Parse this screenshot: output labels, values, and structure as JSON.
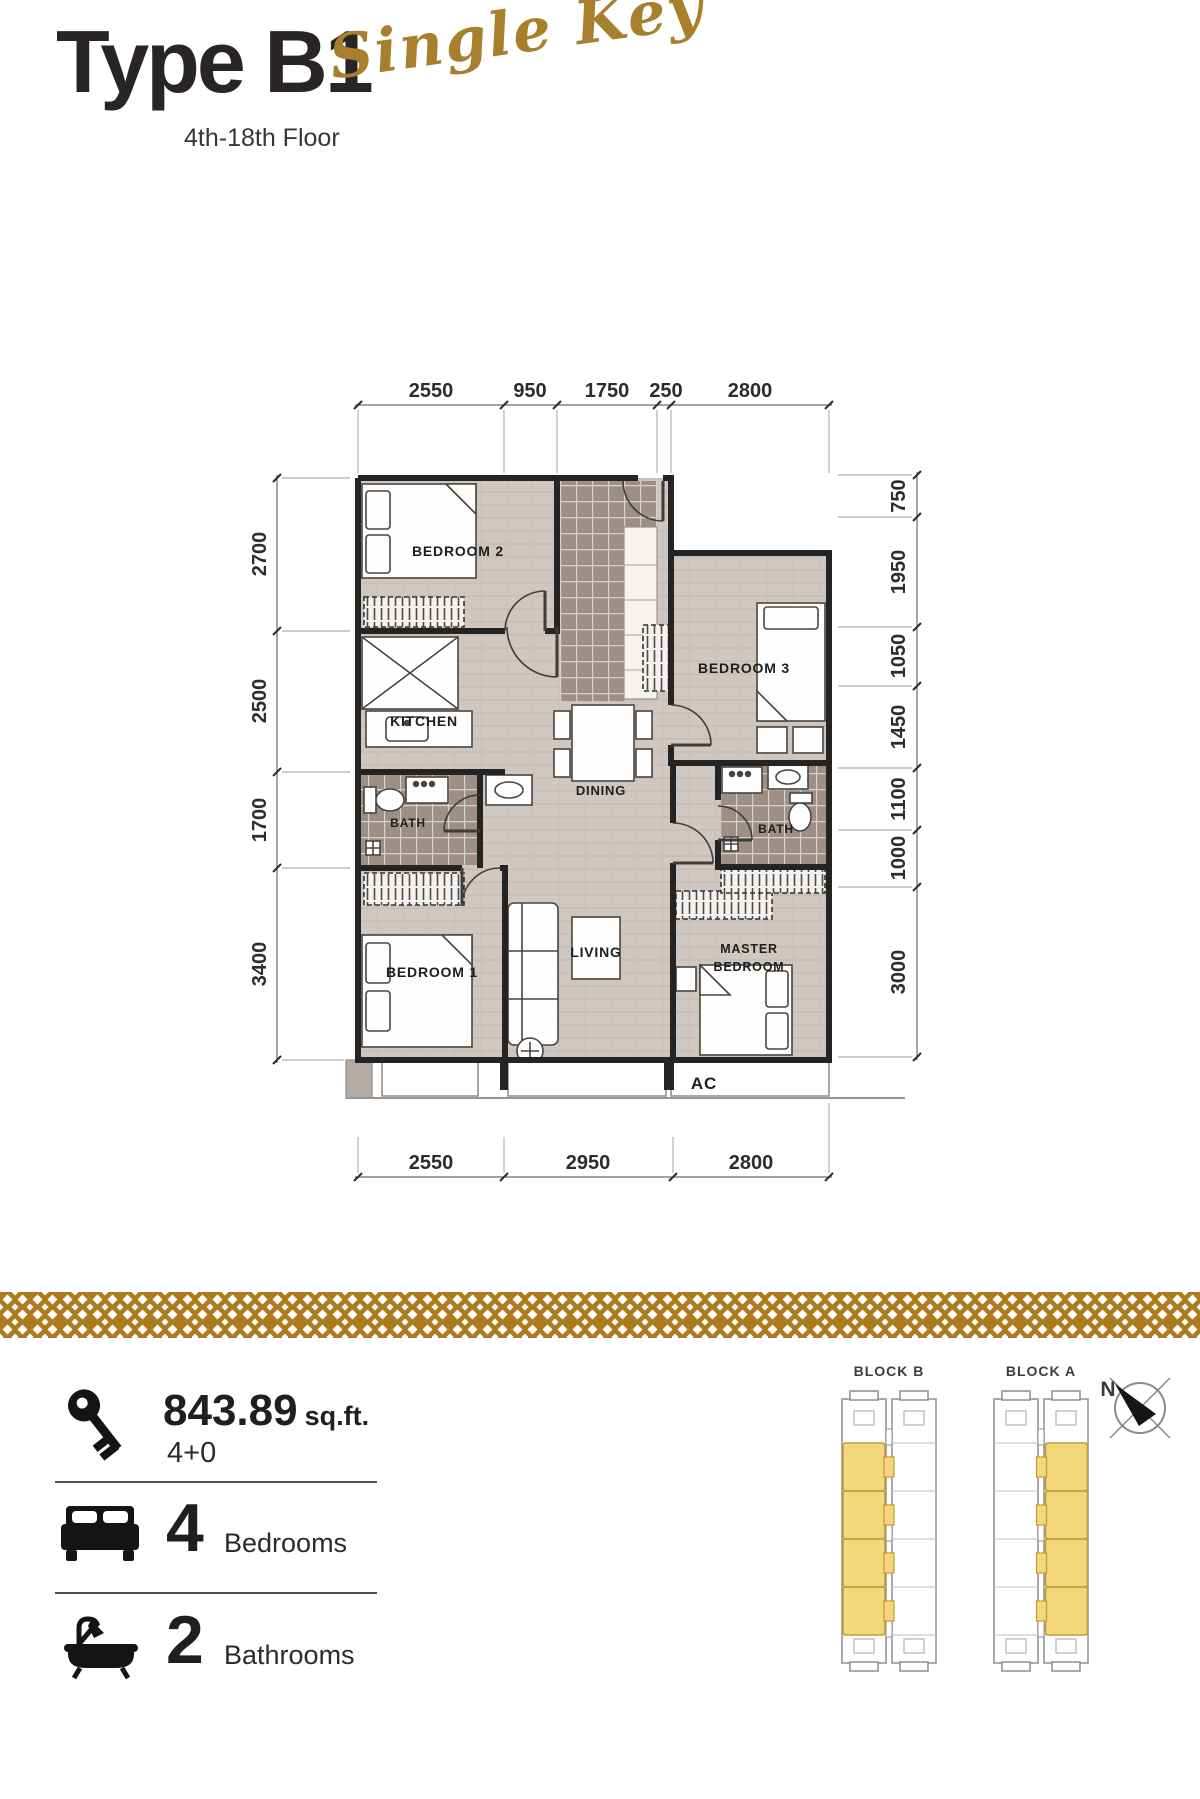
{
  "header": {
    "title": "Type B1",
    "floors": "4th-18th Floor",
    "script": "Single Key",
    "script_color": "#a8802d"
  },
  "plan": {
    "dims": {
      "top": [
        "2550",
        "950",
        "1750",
        "250",
        "2800"
      ],
      "bottom": [
        "2550",
        "2950",
        "2800"
      ],
      "left": [
        "2700",
        "2500",
        "1700",
        "3400"
      ],
      "right": [
        "750",
        "1950",
        "1050",
        "1450",
        "1100",
        "1000",
        "3000"
      ]
    },
    "rooms": {
      "bedroom2": "BEDROOM 2",
      "bedroom3": "BEDROOM 3",
      "kitchen": "KITCHEN",
      "dining": "DINING",
      "bath_left": "BATH",
      "bath_right": "BATH",
      "bedroom1": "BEDROOM 1",
      "living": "LIVING",
      "master_line1": "MASTER",
      "master_line2": "BEDROOM",
      "ac": "AC"
    }
  },
  "info": {
    "area": {
      "value": "843.89",
      "unit": "sq.ft.",
      "config": "4+0"
    },
    "bedrooms": {
      "count": "4",
      "label": "Bedrooms"
    },
    "bathrooms": {
      "count": "2",
      "label": "Bathrooms"
    }
  },
  "keyplan": {
    "block_b": "BLOCK B",
    "block_a": "BLOCK A",
    "compass_n": "N",
    "highlight_color": "#f2d77b",
    "band_color": "#ad7a1c"
  }
}
